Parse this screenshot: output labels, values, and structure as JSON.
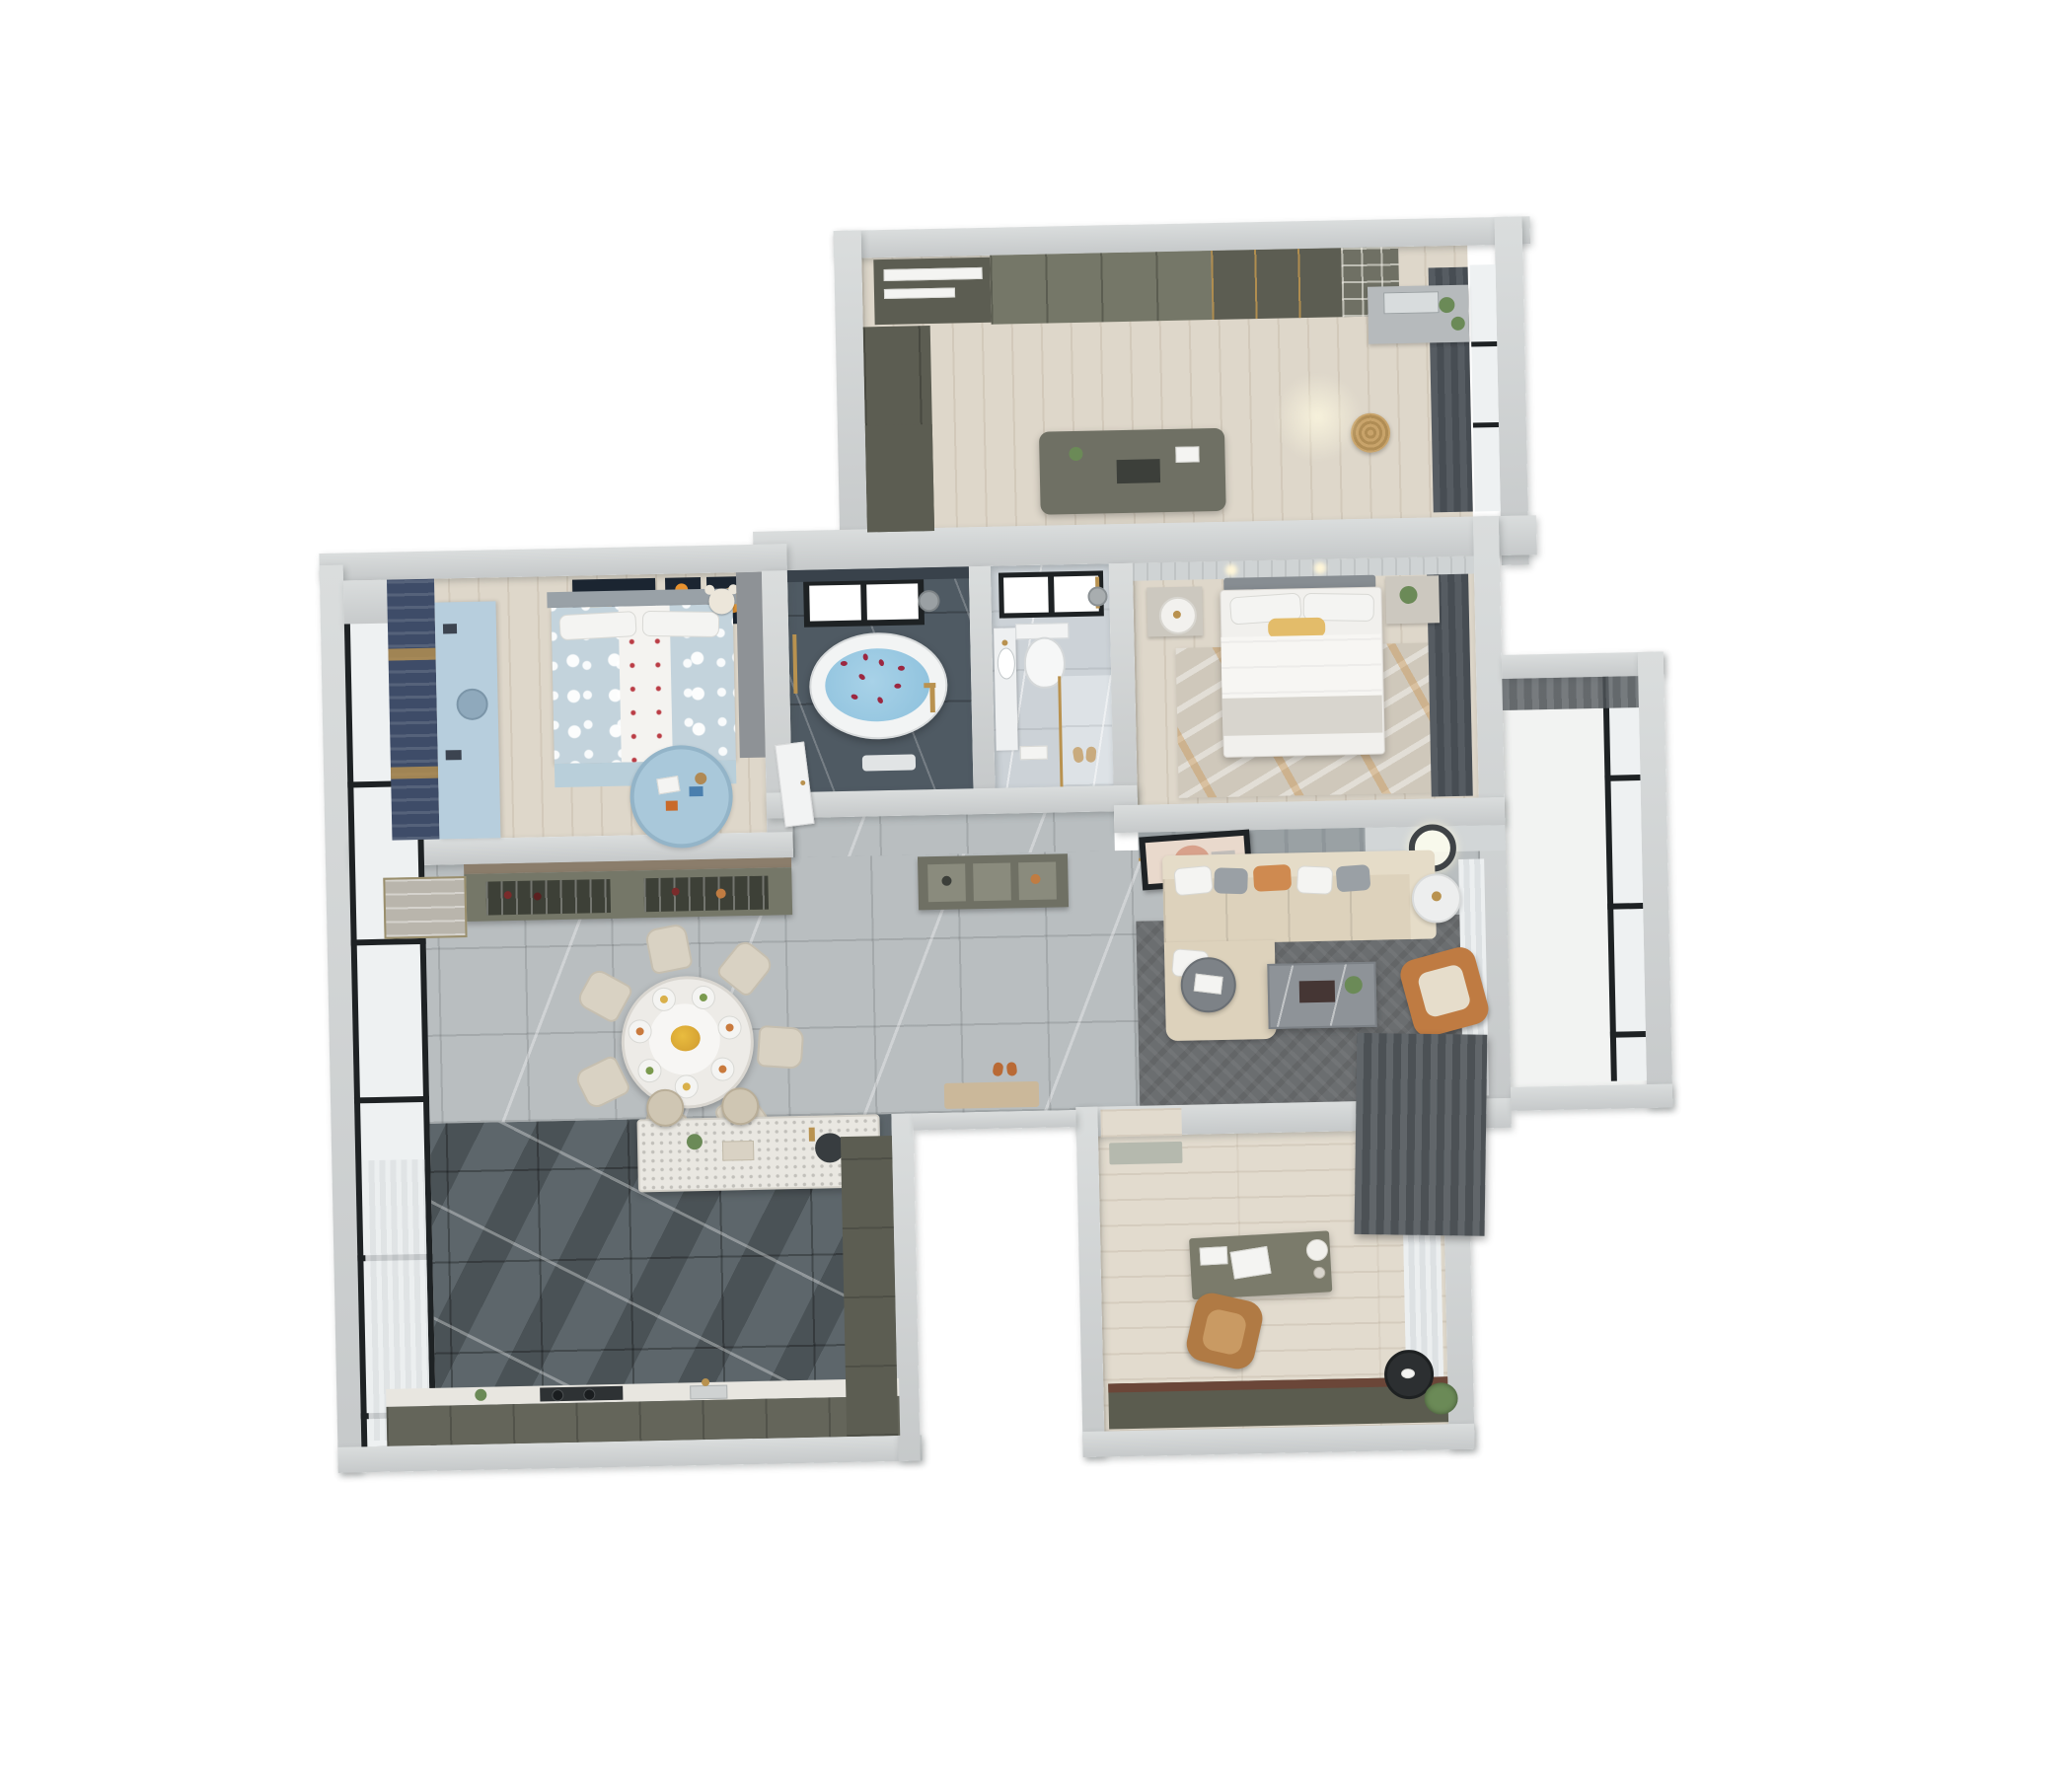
{
  "scene": {
    "type": "3d-floor-plan-render",
    "view": "top-down axonometric apartment rendering on white background",
    "text_visible": "none"
  },
  "palette": {
    "wall": "#c6c9ca",
    "wallLight": "#dadddd",
    "wallEdge": "#a9aeaf",
    "wood": "#ded7ca",
    "woodStudy": "#e2dbce",
    "marble": "#b9bec0",
    "slate": "#5d666b",
    "bathDark": "#4f5a63",
    "bathLight": "#ccd2d7",
    "olive": "#757768",
    "oliveDark": "#5c5d52",
    "oliveMid": "#6f7064",
    "navy": "#3e4c68",
    "kidsBlue": "#c3d3dc",
    "kidsDesk": "#b7cedd",
    "rugBlue": "#a9c8da",
    "sofa": "#ddd2bc",
    "sofaLight": "#e5dcc8",
    "orangeChair": "#bf7b42",
    "accentOrange": "#e8922e",
    "livingRug": "#6b6e70",
    "masterRug": "#cfc8bb",
    "water": "#8cc0dc",
    "petal": "#9c2740",
    "gold": "#b9924f",
    "glass": "#eef1f2",
    "frameBlack": "#1e2224",
    "white": "#f2f3f2",
    "grayPanel": "#9aa1a4",
    "hatchA": "#61666a",
    "hatchB": "#4c5155",
    "curtainA": "#565c62",
    "curtainB": "#474d53",
    "rackDark": "#3d4037",
    "plantGreen": "#6b8a57",
    "tableWhite": "#edebe7",
    "chairBeige": "#d9d2c3"
  },
  "rooms": [
    {
      "name": "walk-in-closet",
      "position": "top-right",
      "floor": "light wood",
      "furniture": [
        "wardrobe-with-hanging-clothes",
        "olive-door-wardrobe",
        "glass-door-wardrobe",
        "open-shelf-unit",
        "dressing-island",
        "vanity-with-mirror-and-plants",
        "rattan-basket",
        "dark-window-curtains",
        "window"
      ]
    },
    {
      "name": "kids-bedroom",
      "position": "top-left",
      "floor": "light wood",
      "furniture": [
        "bed-with-polka-dot-bedding",
        "white-runner-with-red-dots",
        "pillows",
        "teddy-bear",
        "planet-wall-art",
        "navy-curtains-with-tiebacks",
        "light-blue-desk-cabinet",
        "round-play-rug-with-toys",
        "gray-wardrobe"
      ],
      "wall_art_count": 4
    },
    {
      "name": "bathroom-with-bathtub",
      "position": "top-center-left",
      "floor": "dark slate marble",
      "furniture": [
        "freestanding-oval-bathtub",
        "blue-water-with-rose-petals",
        "black-framed-window",
        "gold-floor-faucet",
        "shower-head",
        "bath-mat",
        "gold-towel-bar"
      ]
    },
    {
      "name": "bathroom-with-shower",
      "position": "top-center-right",
      "floor": "light marble",
      "furniture": [
        "wall-hung-toilet",
        "vanity-with-oval-sink",
        "black-framed-window",
        "gold-shower-fixture",
        "glass-partition",
        "mosaic-shower-floor",
        "slippers",
        "towel"
      ]
    },
    {
      "name": "master-bedroom",
      "position": "right-middle",
      "floor": "light wood",
      "furniture": [
        "double-bed-with-white-duvet",
        "yellow-accent-pillow",
        "headboard-panel-wall",
        "ceiling-spotlights",
        "nightstand-with-drum-lamp",
        "nightstand-with-plant",
        "distressed-rug-gray-orange",
        "dark-window-curtains"
      ]
    },
    {
      "name": "dining-area",
      "position": "center-left",
      "floor": "gray marble tile",
      "furniture": [
        "round-dining-table",
        "place-settings",
        "yellow-flower-centerpiece",
        "dining-chairs",
        "wine-and-glass-buffet",
        "display-cabinet",
        "floor-to-ceiling-window-wall"
      ],
      "chair_count": 7,
      "plate_count": 7
    },
    {
      "name": "hallway",
      "position": "center",
      "floor": "gray marble tile",
      "furniture": [
        "white-interior-door",
        "entry-shoe-console",
        "entry-door-mat",
        "slippers"
      ]
    },
    {
      "name": "living-room",
      "position": "center-right",
      "floor": "gray marble tile",
      "furniture": [
        "l-shaped-sectional-sofa",
        "throw-pillows",
        "leaning-abstract-artwork",
        "tv-panel-wall",
        "ceiling-ring-light",
        "marble-coffee-table-with-tray",
        "round-gray-side-table",
        "white-drum-table",
        "orange-leather-armchair",
        "dark-gray-area-rug",
        "sheer-curtains",
        "dark-hanging-curtain-panel"
      ],
      "pillow_count": 6
    },
    {
      "name": "kitchen",
      "position": "bottom-left",
      "floor": "dark slate tile",
      "furniture": [
        "island-counter-with-sink-and-faucet",
        "bar-stools",
        "perimeter-counter-with-cooktop",
        "tall-pantry-cabinet",
        "window-wall-with-sheer-curtain"
      ],
      "stool_count": 2
    },
    {
      "name": "study",
      "position": "bottom-right",
      "floor": "light wood planks",
      "furniture": [
        "desk-with-laptop-and-lamp",
        "tan-leather-office-chair",
        "dark-olive-credenza",
        "door-mat",
        "sheer-curtain",
        "black-round-side-table",
        "potted-plant"
      ]
    },
    {
      "name": "balcony",
      "position": "right",
      "floor": "white",
      "furniture": [
        "black-framed-window-wall",
        "louver-panel"
      ]
    },
    {
      "name": "entrance-recess",
      "position": "bottom-center",
      "floor": "open-to-outside",
      "furniture": [
        "threshold",
        "door-mat"
      ]
    }
  ]
}
